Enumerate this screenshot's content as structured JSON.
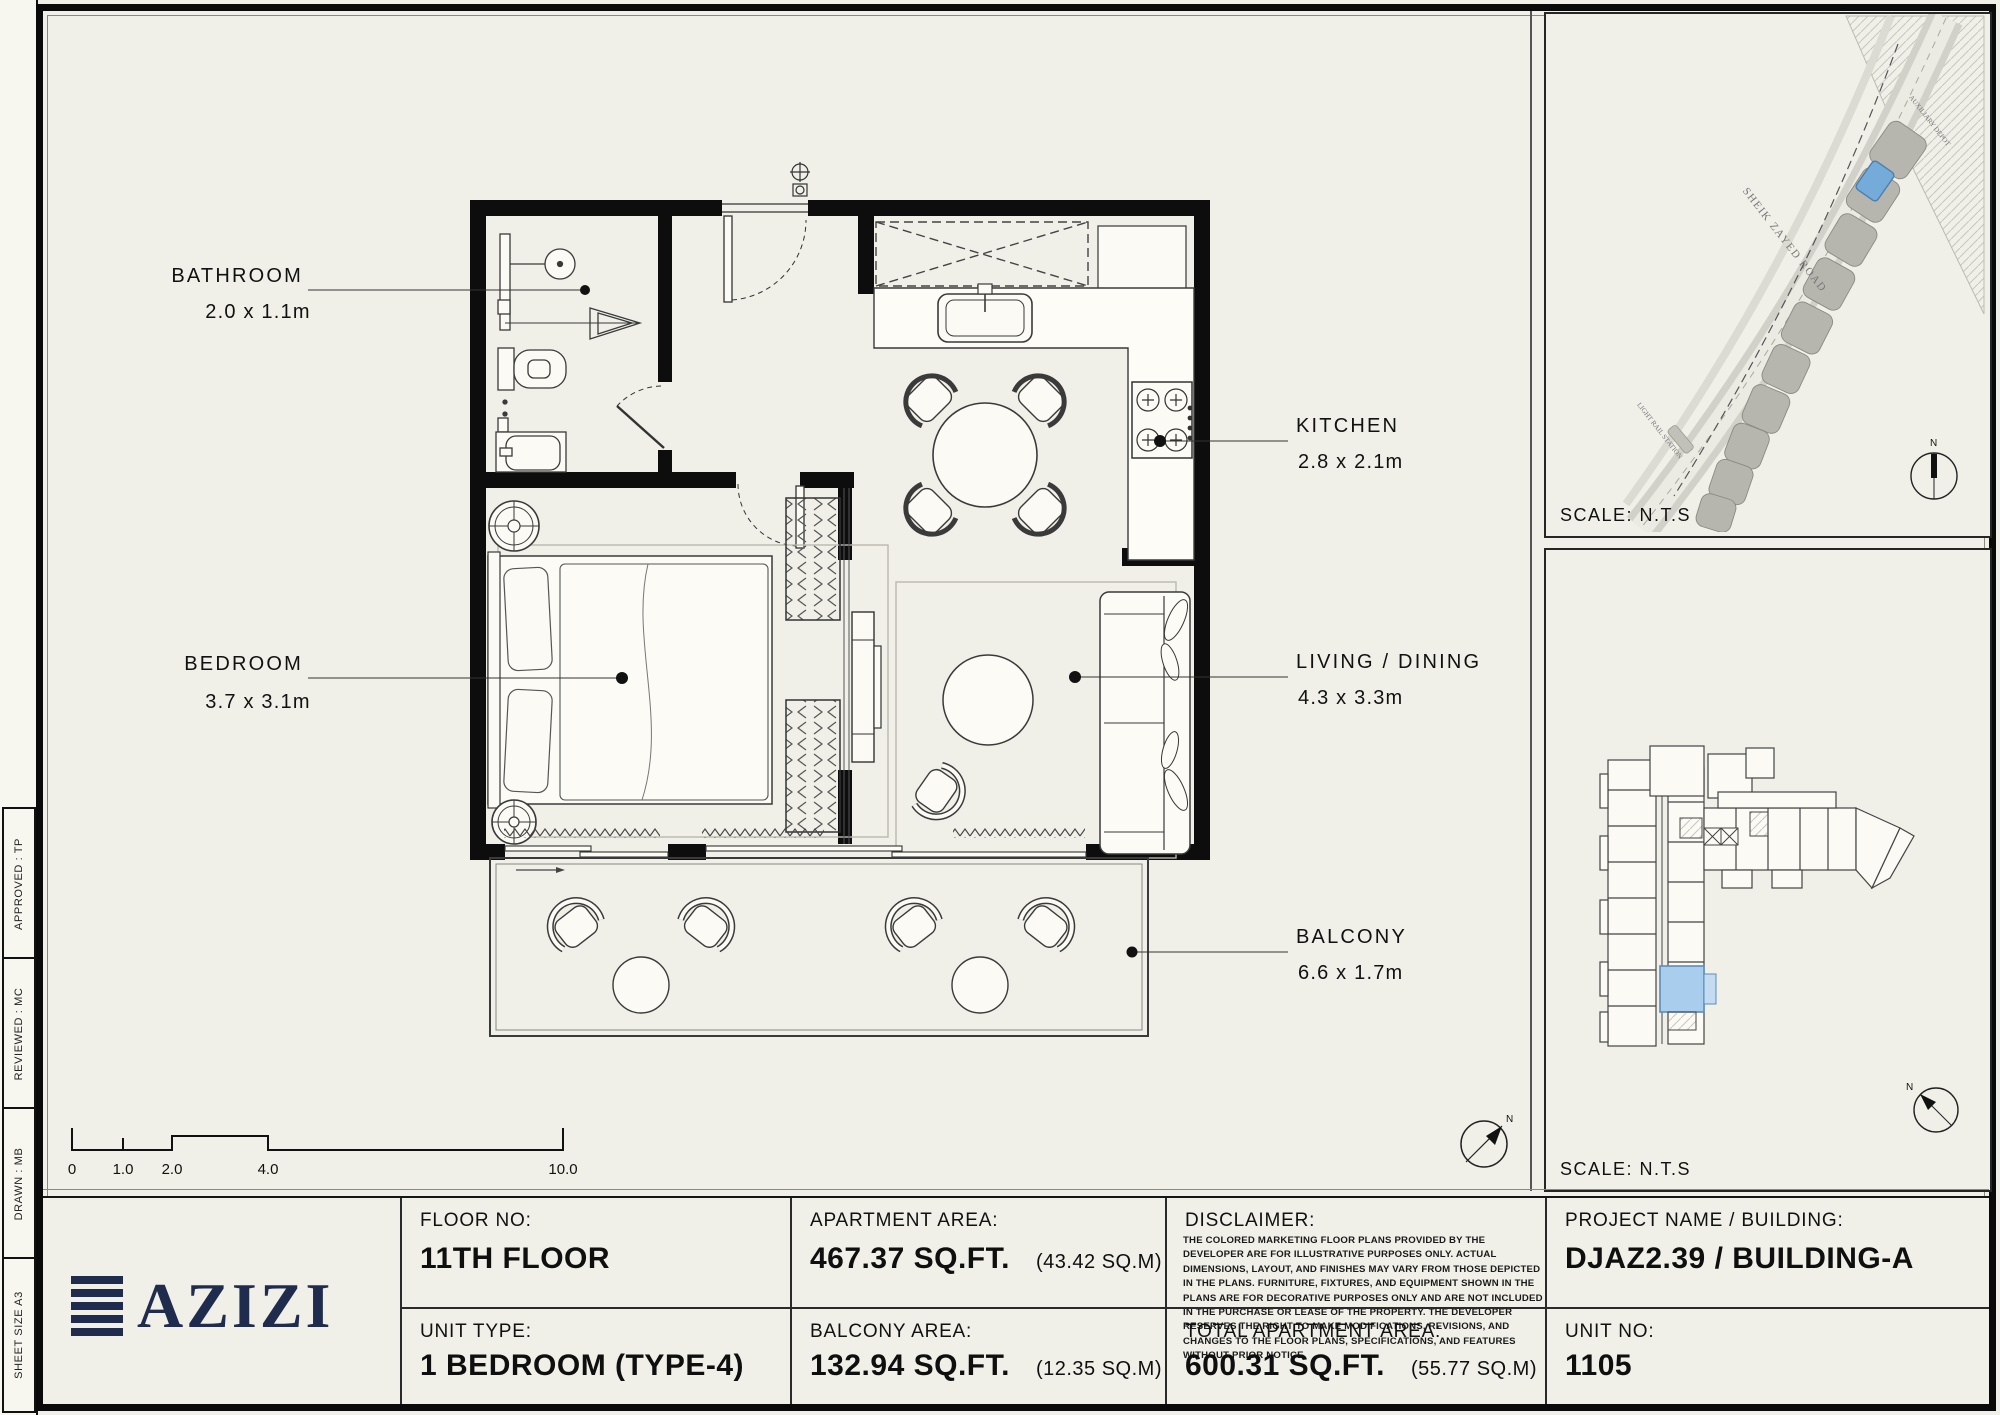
{
  "sidebar": {
    "cells": [
      "SHEET SIZE A3",
      "DRAWN :  MB",
      "REVIEWED :  MC",
      "APPROVED :  TP"
    ]
  },
  "plan": {
    "bathroom_name": "BATHROOM",
    "bathroom_dims": "2.0 x 1.1m",
    "kitchen_name": "KITCHEN",
    "kitchen_dims": "2.8 x 2.1m",
    "bedroom_name": "BEDROOM",
    "bedroom_dims": "3.7 x 3.1m",
    "living_name": "LIVING / DINING",
    "living_dims": "4.3 x 3.3m",
    "balcony_name": "BALCONY",
    "balcony_dims": "6.6 x 1.7m",
    "scale_ticks": [
      "0",
      "1.0",
      "2.0",
      "4.0",
      "10.0"
    ],
    "north": "N"
  },
  "map": {
    "scale": "SCALE: N.T.S",
    "north": "N",
    "road": "SHEIK ZAYED ROAD",
    "light_rail": "LIGHT RAIL STATION",
    "depot": "AUXILIARY DEPOT"
  },
  "keyplan": {
    "scale": "SCALE: N.T.S",
    "north": "N"
  },
  "titleblock": {
    "logo_text": "AZIZI",
    "floor_label": "FLOOR NO:",
    "floor_value": "11TH FLOOR",
    "unit_type_label": "UNIT TYPE:",
    "unit_type_value": "1 BEDROOM (TYPE-4)",
    "apartment_area_label": "APARTMENT AREA:",
    "apartment_area_value": "467.37 SQ.FT.",
    "apartment_area_metric": "(43.42 SQ.M)",
    "balcony_area_label": "BALCONY AREA:",
    "balcony_area_value": "132.94 SQ.FT.",
    "balcony_area_metric": "(12.35 SQ.M)",
    "disclaimer_label": "DISCLAIMER:",
    "disclaimer_text": "THE COLORED MARKETING FLOOR PLANS PROVIDED BY THE DEVELOPER ARE FOR ILLUSTRATIVE PURPOSES ONLY. ACTUAL DIMENSIONS, LAYOUT, AND FINISHES MAY VARY FROM THOSE DEPICTED IN THE PLANS. FURNITURE, FIXTURES, AND EQUIPMENT SHOWN IN THE PLANS ARE FOR DECORATIVE PURPOSES ONLY AND ARE NOT INCLUDED IN THE PURCHASE OR LEASE OF THE PROPERTY. THE DEVELOPER RESERVES THE RIGHT TO MAKE MODIFICATIONS, REVISIONS, AND CHANGES TO THE FLOOR PLANS, SPECIFICATIONS, AND FEATURES WITHOUT PRIOR NOTICE.",
    "total_area_label": "TOTAL APARTMENT AREA:",
    "total_area_value": "600.31 SQ.FT.",
    "total_area_metric": "(55.77 SQ.M)",
    "project_label": "PROJECT NAME / BUILDING:",
    "project_value": "DJAZ2.39 / BUILDING-A",
    "unit_no_label": "UNIT NO:",
    "unit_no_value": "1105"
  },
  "colors": {
    "navy": "#1f2c4e",
    "map_unit_blue": "#74abd8",
    "keyplan_unit_blue": "#a9cdec",
    "wall_black": "#0d0d0d",
    "sheet_cream": "#f0efe8"
  }
}
